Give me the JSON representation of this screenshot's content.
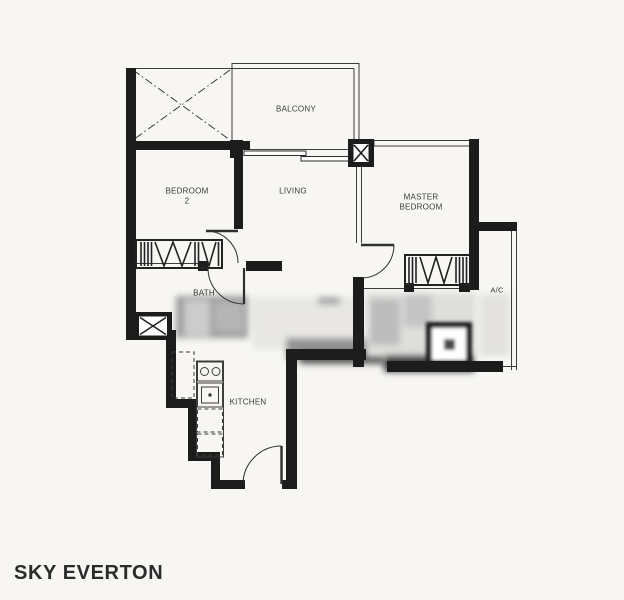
{
  "title": "SKY EVERTON",
  "rooms": {
    "balcony": "BALCONY",
    "bedroom2_line1": "BEDROOM",
    "bedroom2_line2": "2",
    "living": "LIVING",
    "master_line1": "MASTER",
    "master_line2": "BEDROOM",
    "bath": "BATH",
    "ac": "A/C",
    "kitchen": "KITCHEN"
  },
  "symbols": {
    "ledge_cross": "dash-dot X over open ledge",
    "mullion_column": "black column with hourglass glyph",
    "duct_shaft": "small box with X",
    "wardrobe": "hatched stripes with zigzag",
    "sliding_door": "two offset panels",
    "swing_door": "quarter-circle arc",
    "stove_hob": "two burner circles",
    "shower": "dark square with drain"
  },
  "colors": {
    "paper": "#f7f6f3",
    "wall_ink": "#1c1c1c",
    "thin_line": "#3c3c3c",
    "title_ink": "#2b2b2b"
  }
}
